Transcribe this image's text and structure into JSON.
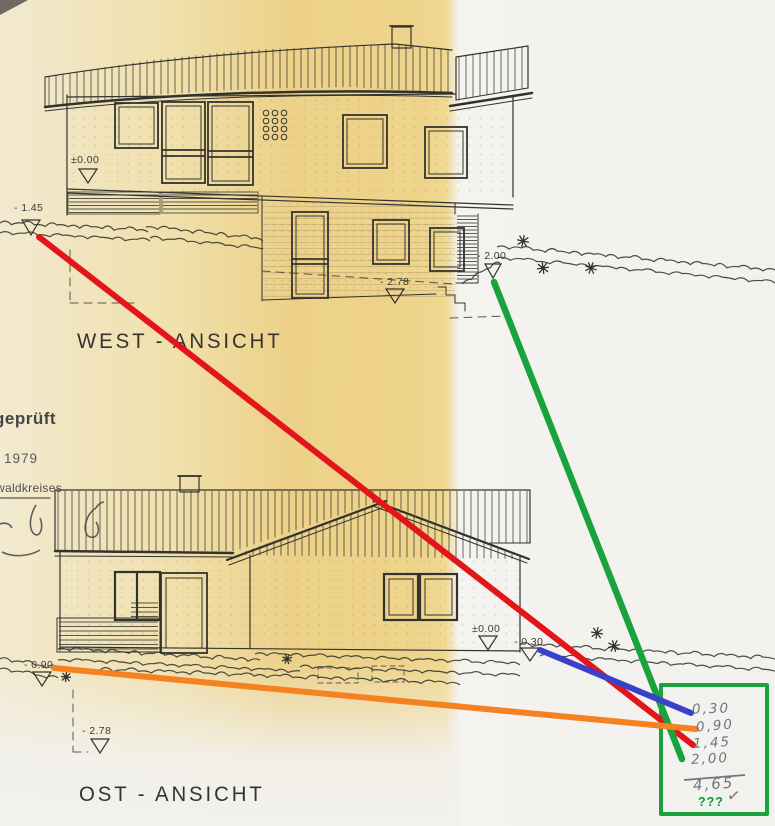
{
  "stamp": {
    "line1": "geprüft",
    "line2": "9. 1979",
    "line3": "waldkreises"
  },
  "west": {
    "title": "WEST - ANSICHT",
    "markers": {
      "zero": "±0.00",
      "m145": "- 1.45",
      "m200": "- 2.00",
      "m278": "- 2.78"
    }
  },
  "east": {
    "title": "OST - ANSICHT",
    "markers": {
      "zero": "±0.00",
      "m030": "- 0.30",
      "m090": "- 0.90",
      "m278": "- 2.78"
    }
  },
  "calc": {
    "rows": [
      "0,30",
      "0,90",
      "1,45",
      "2,00"
    ],
    "sum": "4,65",
    "question": "???",
    "check": "✓"
  },
  "colors": {
    "ink": "#33332e",
    "pencil": "#75757f",
    "red": "#e3151b",
    "green": "#1aa33c",
    "blue": "#3a41c6",
    "orange": "#f58220",
    "question": "#0a9e2f",
    "paper_yellow": "#eed38b",
    "paper_white": "#f2f1ed"
  }
}
